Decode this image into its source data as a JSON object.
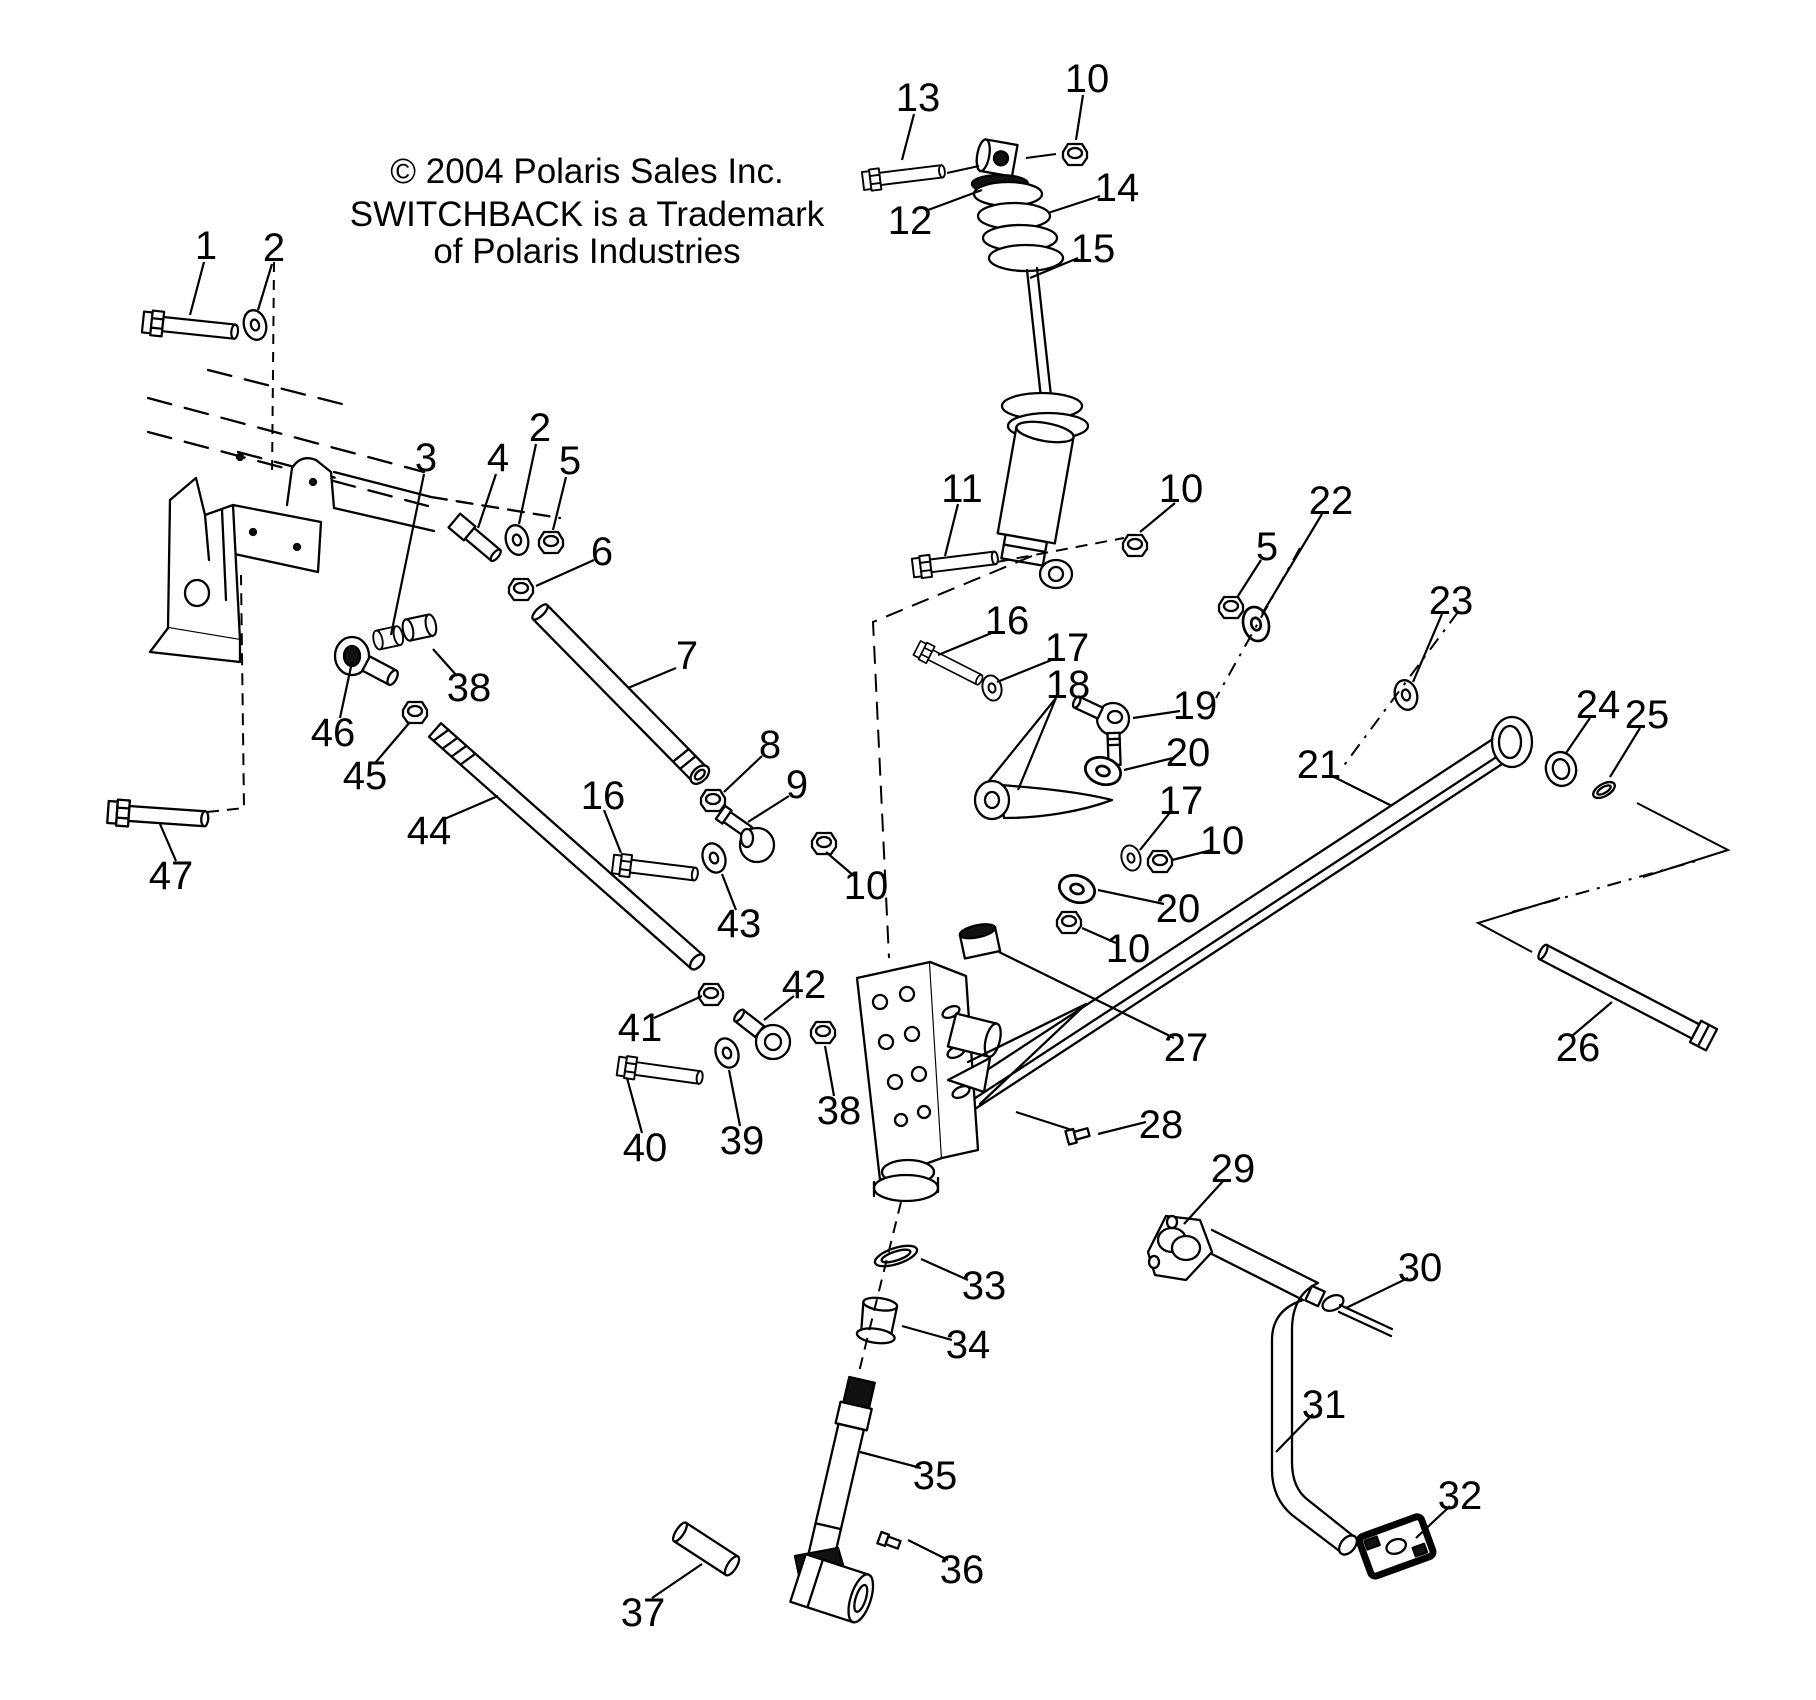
{
  "notice": {
    "line1": "© 2004 Polaris Sales Inc.",
    "line2": "SWITCHBACK is a Trademark",
    "line3": "of Polaris Industries"
  },
  "style": {
    "line_color": "#000000",
    "background": "#ffffff",
    "label_font_size": 40
  },
  "callouts": [
    {
      "label": "1",
      "x": 206,
      "y": 245
    },
    {
      "label": "2",
      "x": 274,
      "y": 247
    },
    {
      "label": "13",
      "x": 918,
      "y": 97
    },
    {
      "label": "10",
      "x": 1087,
      "y": 78
    },
    {
      "label": "12",
      "x": 910,
      "y": 220
    },
    {
      "label": "14",
      "x": 1117,
      "y": 187
    },
    {
      "label": "15",
      "x": 1093,
      "y": 248
    },
    {
      "label": "2",
      "x": 540,
      "y": 427
    },
    {
      "label": "3",
      "x": 426,
      "y": 457
    },
    {
      "label": "4",
      "x": 498,
      "y": 457
    },
    {
      "label": "5",
      "x": 570,
      "y": 460
    },
    {
      "label": "6",
      "x": 602,
      "y": 551
    },
    {
      "label": "11",
      "x": 962,
      "y": 488
    },
    {
      "label": "10",
      "x": 1181,
      "y": 488
    },
    {
      "label": "22",
      "x": 1331,
      "y": 500
    },
    {
      "label": "5",
      "x": 1267,
      "y": 546
    },
    {
      "label": "23",
      "x": 1451,
      "y": 600
    },
    {
      "label": "16",
      "x": 1007,
      "y": 620
    },
    {
      "label": "17",
      "x": 1067,
      "y": 647
    },
    {
      "label": "18",
      "x": 1068,
      "y": 684
    },
    {
      "label": "19",
      "x": 1195,
      "y": 705
    },
    {
      "label": "20",
      "x": 1188,
      "y": 752
    },
    {
      "label": "24",
      "x": 1598,
      "y": 704
    },
    {
      "label": "25",
      "x": 1647,
      "y": 714
    },
    {
      "label": "21",
      "x": 1319,
      "y": 764
    },
    {
      "label": "7",
      "x": 687,
      "y": 655
    },
    {
      "label": "38",
      "x": 469,
      "y": 687
    },
    {
      "label": "46",
      "x": 333,
      "y": 732
    },
    {
      "label": "8",
      "x": 770,
      "y": 744
    },
    {
      "label": "45",
      "x": 365,
      "y": 775
    },
    {
      "label": "9",
      "x": 797,
      "y": 784
    },
    {
      "label": "16",
      "x": 603,
      "y": 795
    },
    {
      "label": "17",
      "x": 1181,
      "y": 800
    },
    {
      "label": "44",
      "x": 429,
      "y": 830
    },
    {
      "label": "10",
      "x": 1222,
      "y": 840
    },
    {
      "label": "47",
      "x": 171,
      "y": 875
    },
    {
      "label": "10",
      "x": 866,
      "y": 885
    },
    {
      "label": "20",
      "x": 1178,
      "y": 908
    },
    {
      "label": "43",
      "x": 739,
      "y": 923
    },
    {
      "label": "10",
      "x": 1128,
      "y": 948
    },
    {
      "label": "42",
      "x": 804,
      "y": 984
    },
    {
      "label": "41",
      "x": 640,
      "y": 1027
    },
    {
      "label": "26",
      "x": 1578,
      "y": 1047
    },
    {
      "label": "27",
      "x": 1186,
      "y": 1047
    },
    {
      "label": "38",
      "x": 839,
      "y": 1110
    },
    {
      "label": "28",
      "x": 1161,
      "y": 1124
    },
    {
      "label": "39",
      "x": 742,
      "y": 1140
    },
    {
      "label": "40",
      "x": 645,
      "y": 1147
    },
    {
      "label": "29",
      "x": 1233,
      "y": 1168
    },
    {
      "label": "30",
      "x": 1420,
      "y": 1267
    },
    {
      "label": "33",
      "x": 984,
      "y": 1285
    },
    {
      "label": "34",
      "x": 968,
      "y": 1344
    },
    {
      "label": "31",
      "x": 1324,
      "y": 1404
    },
    {
      "label": "35",
      "x": 935,
      "y": 1475
    },
    {
      "label": "32",
      "x": 1460,
      "y": 1495
    },
    {
      "label": "36",
      "x": 962,
      "y": 1569
    },
    {
      "label": "37",
      "x": 643,
      "y": 1612
    }
  ]
}
